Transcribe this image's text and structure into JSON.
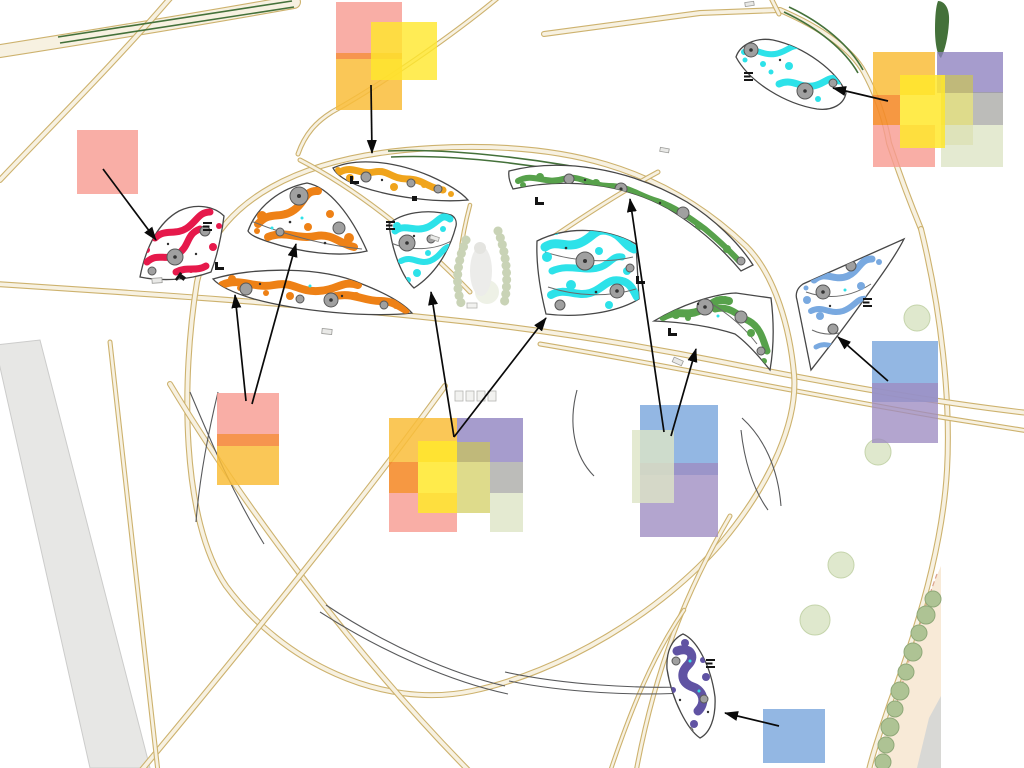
{
  "canvas": {
    "width": 1024,
    "height": 768,
    "background": "#ffffff"
  },
  "colors": {
    "page_bg": "#ffffff",
    "road_edge": "#cdb26e",
    "road_fill": "#f7f1e1",
    "road_gray_fill": "#e7e7e5",
    "road_gray_edge": "#cccccb",
    "hedge": "#44713a",
    "tree_fill": "#dfe8cd",
    "tree_edge": "#c5d4ab",
    "tree_row_fill": "#aec394",
    "tree_row_edge": "#8fa878",
    "bed_outline": "#474747",
    "plant_gray": "#a0a0a0",
    "plant_gray_dark": "#585858",
    "bed_red": "#e6194b",
    "bed_orange": "#ee8116",
    "bed_marigold": "#f0a41c",
    "bed_cyan": "#2de2e9",
    "bed_green": "#57a14b",
    "bed_blue": "#79a9e0",
    "bed_purple": "#6053a3",
    "building_fill": "#f8ead7",
    "building_edge": "#dba28c",
    "pebble": "#c9d3b6",
    "detail_line": "#58595b",
    "arrow": "#0a0a0a"
  },
  "swatch_colors": {
    "pink": "#F79A90",
    "band_orange": "#F58A3C",
    "amber": "#F9BD3A",
    "yellow": "#FFE72B",
    "lavender": "#8D80BF",
    "orange": "#F58A28",
    "olive": "#CDC94F",
    "gray": "#9F9F9B",
    "celadon": "#DDE5C6",
    "blue": "#7BA7DD",
    "purple": "#9D8CC2"
  },
  "beds": [
    {
      "id": "red-bed",
      "color": "bed_red"
    },
    {
      "id": "orange-upper-bed",
      "color": "bed_orange"
    },
    {
      "id": "orange-lower-bed",
      "color": "bed_orange"
    },
    {
      "id": "marigold-top-bed",
      "color": "bed_marigold"
    },
    {
      "id": "cyan-fan-bed",
      "color": "bed_cyan"
    },
    {
      "id": "cyan-large-bed",
      "color": "bed_cyan"
    },
    {
      "id": "cyan-topright-bed",
      "color": "bed_cyan"
    },
    {
      "id": "green-crescent-bed",
      "color": "bed_green"
    },
    {
      "id": "green-lower-bed",
      "color": "bed_green"
    },
    {
      "id": "blue-bed",
      "color": "bed_blue"
    },
    {
      "id": "purple-bed",
      "color": "bed_purple"
    }
  ],
  "palettes": [
    {
      "id": "palette-top-left",
      "squares": [
        {
          "color": "pink",
          "x": 336,
          "y": 2,
          "w": 66,
          "h": 51,
          "alpha": 0.8
        },
        {
          "color": "band_orange",
          "x": 336,
          "y": 53,
          "w": 66,
          "h": 6,
          "alpha": 0.9
        },
        {
          "color": "amber",
          "x": 336,
          "y": 59,
          "w": 66,
          "h": 51,
          "alpha": 0.85
        },
        {
          "color": "yellow",
          "x": 371,
          "y": 22,
          "w": 66,
          "h": 58,
          "alpha": 0.8
        }
      ]
    },
    {
      "id": "swatch-pink-left",
      "squares": [
        {
          "color": "pink",
          "x": 77,
          "y": 130,
          "w": 61,
          "h": 64,
          "alpha": 0.8
        }
      ]
    },
    {
      "id": "palette-mid-left",
      "squares": [
        {
          "color": "pink",
          "x": 217,
          "y": 393,
          "w": 62,
          "h": 41,
          "alpha": 0.8
        },
        {
          "color": "band_orange",
          "x": 217,
          "y": 434,
          "w": 62,
          "h": 12,
          "alpha": 0.9
        },
        {
          "color": "amber",
          "x": 217,
          "y": 446,
          "w": 62,
          "h": 39,
          "alpha": 0.85
        }
      ]
    },
    {
      "id": "palette-center",
      "squares": [
        {
          "color": "amber",
          "x": 389,
          "y": 418,
          "w": 68,
          "h": 44,
          "alpha": 0.85
        },
        {
          "color": "lavender",
          "x": 457,
          "y": 418,
          "w": 66,
          "h": 44,
          "alpha": 0.78
        },
        {
          "color": "orange",
          "x": 389,
          "y": 462,
          "w": 29,
          "h": 31,
          "alpha": 0.88
        },
        {
          "color": "olive",
          "x": 457,
          "y": 442,
          "w": 33,
          "h": 71,
          "alpha": 0.66
        },
        {
          "color": "gray",
          "x": 490,
          "y": 462,
          "w": 33,
          "h": 31,
          "alpha": 0.7
        },
        {
          "color": "pink",
          "x": 389,
          "y": 493,
          "w": 68,
          "h": 39,
          "alpha": 0.8
        },
        {
          "color": "celadon",
          "x": 490,
          "y": 493,
          "w": 33,
          "h": 39,
          "alpha": 0.8
        },
        {
          "color": "yellow",
          "x": 418,
          "y": 441,
          "w": 39,
          "h": 72,
          "alpha": 0.85
        }
      ]
    },
    {
      "id": "palette-right-center",
      "squares": [
        {
          "color": "blue",
          "x": 640,
          "y": 405,
          "w": 78,
          "h": 70,
          "alpha": 0.82
        },
        {
          "color": "purple",
          "x": 640,
          "y": 463,
          "w": 78,
          "h": 74,
          "alpha": 0.78
        },
        {
          "color": "celadon",
          "x": 632,
          "y": 430,
          "w": 42,
          "h": 73,
          "alpha": 0.8
        }
      ]
    },
    {
      "id": "palette-right",
      "squares": [
        {
          "color": "blue",
          "x": 872,
          "y": 341,
          "w": 66,
          "h": 61,
          "alpha": 0.82
        },
        {
          "color": "purple",
          "x": 872,
          "y": 383,
          "w": 66,
          "h": 60,
          "alpha": 0.78
        }
      ]
    },
    {
      "id": "palette-top-right",
      "squares": [
        {
          "color": "amber",
          "x": 873,
          "y": 52,
          "w": 62,
          "h": 43,
          "alpha": 0.85
        },
        {
          "color": "lavender",
          "x": 937,
          "y": 52,
          "w": 66,
          "h": 41,
          "alpha": 0.78
        },
        {
          "color": "orange",
          "x": 873,
          "y": 95,
          "w": 27,
          "h": 30,
          "alpha": 0.88
        },
        {
          "color": "olive",
          "x": 941,
          "y": 75,
          "w": 32,
          "h": 70,
          "alpha": 0.66
        },
        {
          "color": "gray",
          "x": 973,
          "y": 92,
          "w": 30,
          "h": 33,
          "alpha": 0.7
        },
        {
          "color": "pink",
          "x": 873,
          "y": 125,
          "w": 62,
          "h": 42,
          "alpha": 0.8
        },
        {
          "color": "celadon",
          "x": 941,
          "y": 125,
          "w": 62,
          "h": 42,
          "alpha": 0.8
        },
        {
          "color": "yellow",
          "x": 900,
          "y": 75,
          "w": 45,
          "h": 73,
          "alpha": 0.85
        }
      ]
    },
    {
      "id": "swatch-blue-bottom",
      "squares": [
        {
          "color": "blue",
          "x": 763,
          "y": 709,
          "w": 62,
          "h": 54,
          "alpha": 0.82
        }
      ]
    }
  ],
  "arrows": [
    {
      "id": "arrow-marigold",
      "from_palette": "palette-top-left",
      "to_bed": "marigold-top-bed",
      "x1": 371,
      "y1": 85,
      "x2": 372,
      "y2": 153
    },
    {
      "id": "arrow-red",
      "from_palette": "swatch-pink-left",
      "to_bed": "red-bed",
      "x1": 103,
      "y1": 169,
      "x2": 156,
      "y2": 240
    },
    {
      "id": "arrow-orange-lower",
      "from_palette": "palette-mid-left",
      "to_bed": "orange-lower-bed",
      "x1": 246,
      "y1": 401,
      "x2": 235,
      "y2": 295
    },
    {
      "id": "arrow-orange-upper",
      "from_palette": "palette-mid-left",
      "to_bed": "orange-upper-bed",
      "x1": 252,
      "y1": 404,
      "x2": 296,
      "y2": 244
    },
    {
      "id": "arrow-cyan-fan",
      "from_palette": "palette-center",
      "to_bed": "cyan-fan-bed",
      "x1": 454,
      "y1": 437,
      "x2": 431,
      "y2": 292
    },
    {
      "id": "arrow-cyan-large",
      "from_palette": "palette-center",
      "to_bed": "cyan-large-bed",
      "x1": 454,
      "y1": 437,
      "x2": 546,
      "y2": 318
    },
    {
      "id": "arrow-green-crescent",
      "from_palette": "palette-right-center",
      "to_bed": "green-crescent-bed",
      "x1": 664,
      "y1": 432,
      "x2": 630,
      "y2": 199
    },
    {
      "id": "arrow-green-lower",
      "from_palette": "palette-right-center",
      "to_bed": "green-lower-bed",
      "x1": 671,
      "y1": 436,
      "x2": 696,
      "y2": 349
    },
    {
      "id": "arrow-blue",
      "from_palette": "palette-right",
      "to_bed": "blue-bed",
      "x1": 888,
      "y1": 381,
      "x2": 838,
      "y2": 337
    },
    {
      "id": "arrow-cyan-topright",
      "from_palette": "palette-top-right",
      "to_bed": "cyan-topright-bed",
      "x1": 888,
      "y1": 101,
      "x2": 833,
      "y2": 88
    },
    {
      "id": "arrow-purple",
      "from_palette": "swatch-blue-bottom",
      "to_bed": "purple-bed",
      "x1": 779,
      "y1": 726,
      "x2": 725,
      "y2": 713
    }
  ]
}
